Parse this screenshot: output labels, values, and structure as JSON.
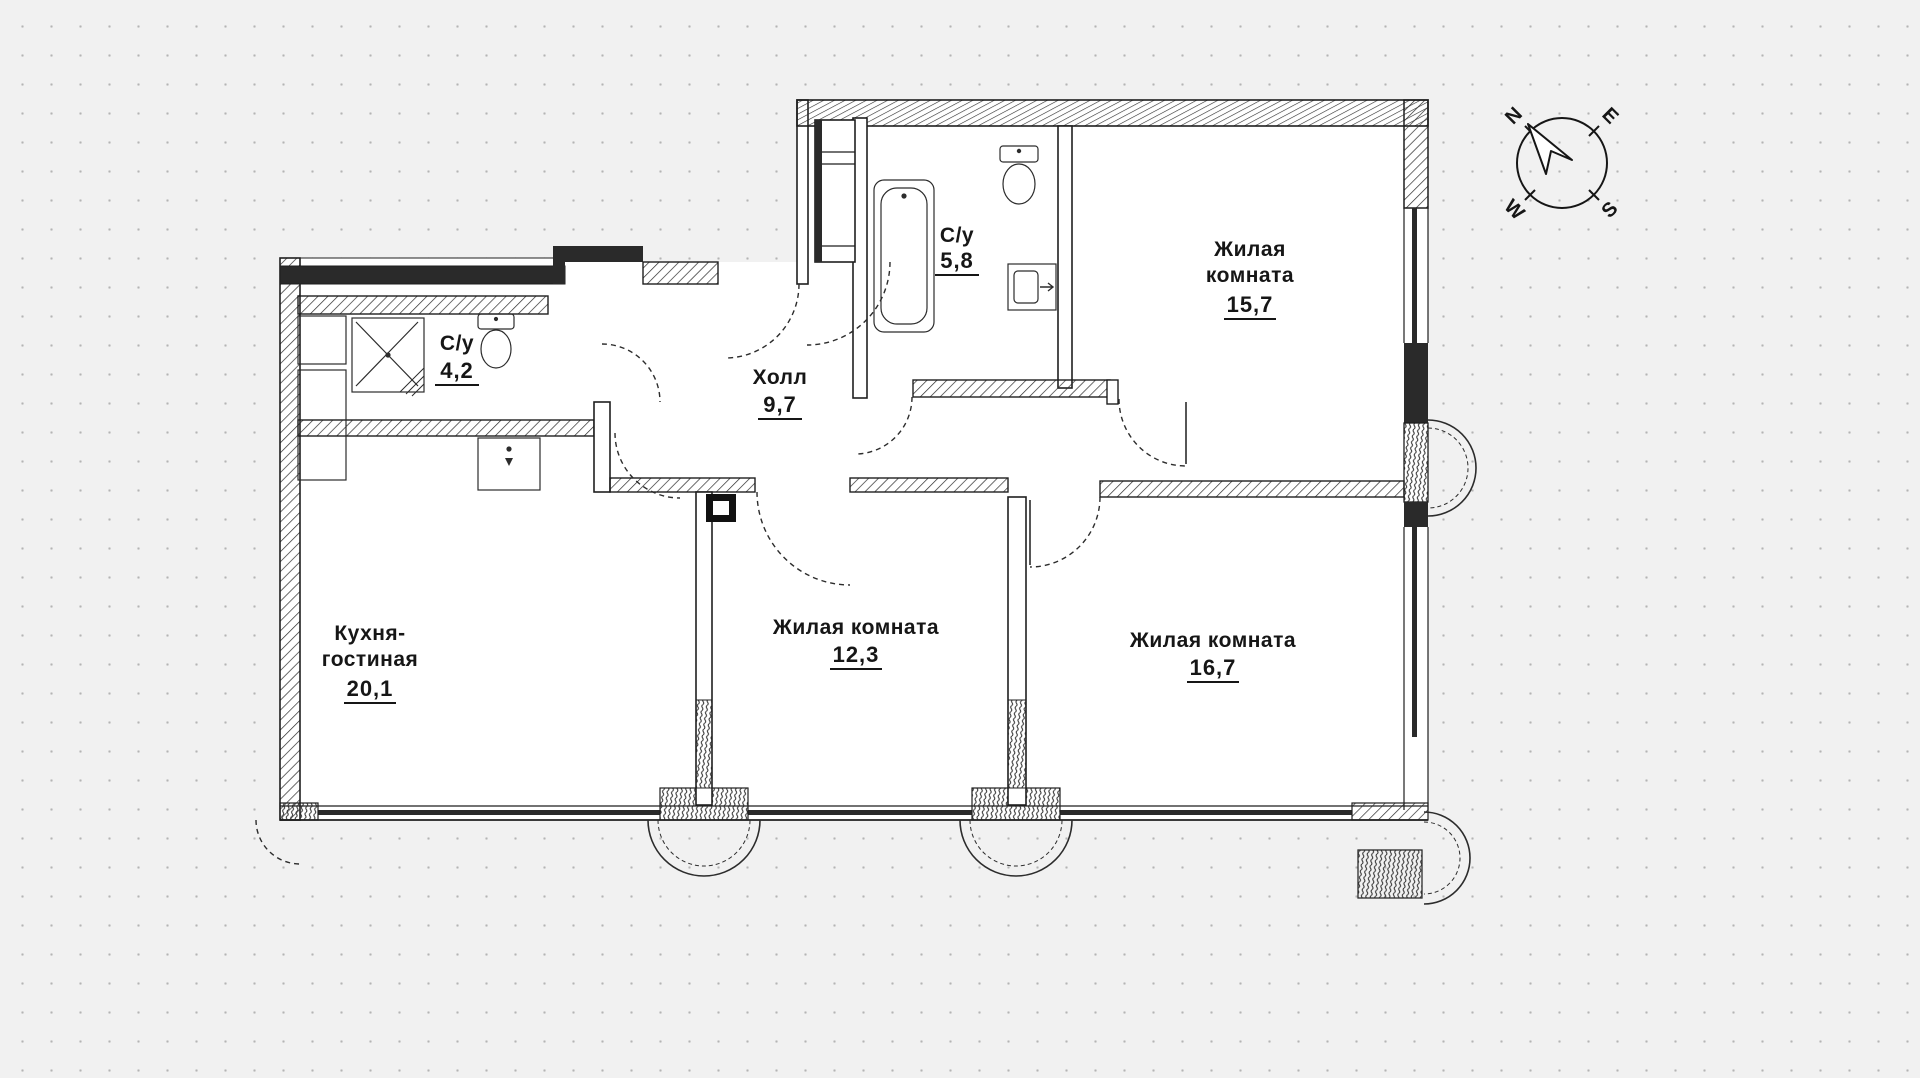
{
  "plan": {
    "title_hint": "apartment floor plan",
    "rooms": [
      {
        "id": "kitchen-living",
        "name_lines": [
          "Кухня-",
          "гостиная"
        ],
        "area": "20,1"
      },
      {
        "id": "hall",
        "name_lines": [
          "Холл"
        ],
        "area": "9,7"
      },
      {
        "id": "bath-small",
        "name_lines": [
          "С/у"
        ],
        "area": "4,2"
      },
      {
        "id": "bath-big",
        "name_lines": [
          "С/у"
        ],
        "area": "5,8"
      },
      {
        "id": "living-room-1",
        "name_lines": [
          "Жилая",
          "комната"
        ],
        "area": "15,7"
      },
      {
        "id": "living-room-2",
        "name_lines": [
          "Жилая комната"
        ],
        "area": "12,3"
      },
      {
        "id": "living-room-3",
        "name_lines": [
          "Жилая комната"
        ],
        "area": "16,7"
      }
    ],
    "colors": {
      "line": "#1f1f1f",
      "paper": "#f1f1f1",
      "dots": "#b4b4b4",
      "wall_fill": "#2a2a2a"
    }
  },
  "compass": {
    "labels": {
      "n": "N",
      "e": "E",
      "s": "S",
      "w": "W"
    }
  }
}
